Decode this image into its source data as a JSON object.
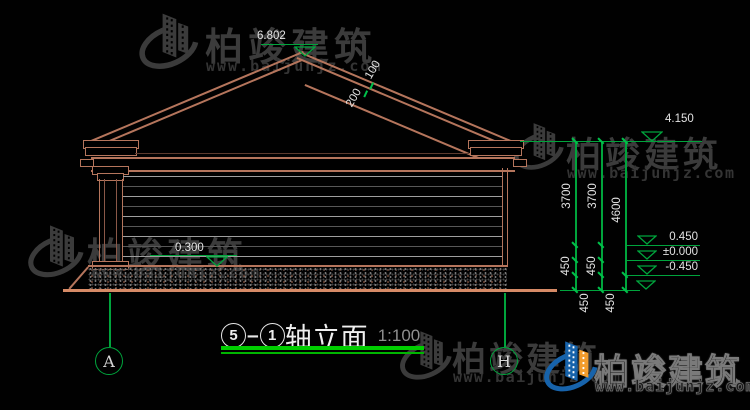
{
  "brand": {
    "name": "柏竣建筑",
    "url": "www.baijunjz.com"
  },
  "title": {
    "axis_start": "5",
    "sep": "–",
    "axis_end": "1",
    "text": "轴立面",
    "scale": "1:100"
  },
  "axes": {
    "left": "A",
    "right": "H"
  },
  "levels": {
    "ridge": "6.802",
    "eave": "4.150",
    "plinth": "0.300",
    "top": "0.450",
    "zero": "±0.000",
    "neg": "-0.450"
  },
  "dims": {
    "wall": "3700",
    "total": "4600",
    "step": "450",
    "roof_a": "200",
    "roof_b": "100"
  },
  "colors": {
    "line_salmon": "#b5755c",
    "ground_salmon": "#d68a66",
    "dim_green": "#00a43c",
    "title_green": "#00ce00",
    "logo_blue": "#1763ab",
    "logo_orange": "#f39c2c",
    "watermark_gray": "#3b3b3b"
  }
}
